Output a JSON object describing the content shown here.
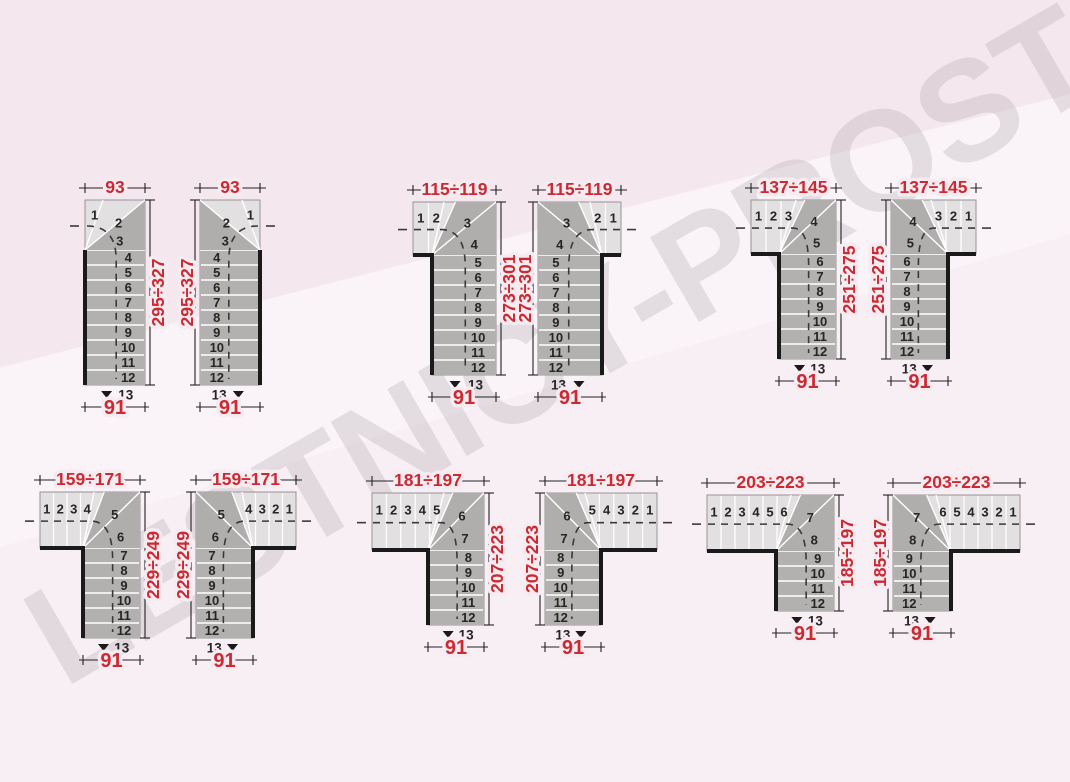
{
  "page": {
    "description": "Staircase layout dimension diagrams, 6 variants in left-hand and right-hand versions"
  },
  "watermark": {
    "text": "LESTNICY-PROSTO.RU"
  },
  "colors": {
    "background": "#f6ebf1",
    "step_light": "#e2e0e0",
    "step_dark": "#b3b0b0",
    "winder_dark": "#b0adad",
    "separator": "#ffffff",
    "outline": "#979595",
    "wall": "#1a1a1a",
    "walkline": "#3a3a3a",
    "dimension_red": "#cb2a32",
    "number_color": "#262626"
  },
  "stairs": [
    {
      "id": "93-left",
      "mirrored": false,
      "dimensions": {
        "top": "93",
        "side": "295÷327",
        "bottom": "91"
      },
      "step_numbers": {
        "arm": [],
        "winders": [
          "1",
          "2",
          "3"
        ],
        "flight": [
          "4",
          "5",
          "6",
          "7",
          "8",
          "9",
          "10",
          "11",
          "12"
        ],
        "last": "13"
      },
      "layout": {
        "left": 85,
        "top": 200,
        "total_w": 60,
        "flight_w": 60,
        "arm_w": 0,
        "arm_span": 0,
        "corner_h": 50,
        "step_depth": 15
      }
    },
    {
      "id": "93-right",
      "mirrored": true,
      "dimensions": {
        "top": "93",
        "side": "295÷327",
        "bottom": "91"
      },
      "step_numbers": {
        "arm": [],
        "winders": [
          "1",
          "2",
          "3"
        ],
        "flight": [
          "4",
          "5",
          "6",
          "7",
          "8",
          "9",
          "10",
          "11",
          "12"
        ],
        "last": "13"
      },
      "layout": {
        "left": 200,
        "top": 200,
        "total_w": 60,
        "flight_w": 60,
        "arm_w": 0,
        "arm_span": 0,
        "corner_h": 50,
        "step_depth": 15
      }
    },
    {
      "id": "115-119-left",
      "mirrored": false,
      "dimensions": {
        "top": "115÷119",
        "side": "273÷301",
        "bottom": "91"
      },
      "step_numbers": {
        "arm": [
          "1",
          "2"
        ],
        "winders": [
          "3",
          "4"
        ],
        "flight": [
          "5",
          "6",
          "7",
          "8",
          "9",
          "10",
          "11",
          "12"
        ],
        "last": "13"
      },
      "layout": {
        "left": 413,
        "top": 202,
        "total_w": 83,
        "flight_w": 64,
        "arm_w": 19,
        "arm_span": 31,
        "corner_h": 53,
        "step_depth": 15
      }
    },
    {
      "id": "115-119-right",
      "mirrored": true,
      "dimensions": {
        "top": "115÷119",
        "side": "273÷301",
        "bottom": "91"
      },
      "step_numbers": {
        "arm": [
          "1",
          "2"
        ],
        "winders": [
          "3",
          "4"
        ],
        "flight": [
          "5",
          "6",
          "7",
          "8",
          "9",
          "10",
          "11",
          "12"
        ],
        "last": "13"
      },
      "layout": {
        "left": 538,
        "top": 202,
        "total_w": 83,
        "flight_w": 64,
        "arm_w": 19,
        "arm_span": 31,
        "corner_h": 53,
        "step_depth": 15
      }
    },
    {
      "id": "137-145-left",
      "mirrored": false,
      "dimensions": {
        "top": "137÷145",
        "side": "251÷275",
        "bottom": "91"
      },
      "step_numbers": {
        "arm": [
          "1",
          "2",
          "3"
        ],
        "winders": [
          "4",
          "5"
        ],
        "flight": [
          "6",
          "7",
          "8",
          "9",
          "10",
          "11",
          "12"
        ],
        "last": "13"
      },
      "layout": {
        "left": 751,
        "top": 200,
        "total_w": 85,
        "flight_w": 57,
        "arm_w": 28,
        "arm_span": 45,
        "corner_h": 54,
        "step_depth": 15
      }
    },
    {
      "id": "137-145-right",
      "mirrored": true,
      "dimensions": {
        "top": "137÷145",
        "side": "251÷275",
        "bottom": "91"
      },
      "step_numbers": {
        "arm": [
          "1",
          "2",
          "3"
        ],
        "winders": [
          "4",
          "5"
        ],
        "flight": [
          "6",
          "7",
          "8",
          "9",
          "10",
          "11",
          "12"
        ],
        "last": "13"
      },
      "layout": {
        "left": 891,
        "top": 200,
        "total_w": 85,
        "flight_w": 57,
        "arm_w": 28,
        "arm_span": 45,
        "corner_h": 54,
        "step_depth": 15
      }
    },
    {
      "id": "159-171-left",
      "mirrored": false,
      "dimensions": {
        "top": "159÷171",
        "side": "229÷249",
        "bottom": "91"
      },
      "step_numbers": {
        "arm": [
          "1",
          "2",
          "3",
          "4"
        ],
        "winders": [
          "5",
          "6"
        ],
        "flight": [
          "7",
          "8",
          "9",
          "10",
          "11",
          "12"
        ],
        "last": "13"
      },
      "layout": {
        "left": 40,
        "top": 492,
        "total_w": 100,
        "flight_w": 57,
        "arm_w": 43,
        "arm_span": 54,
        "corner_h": 56,
        "step_depth": 15
      }
    },
    {
      "id": "159-171-right",
      "mirrored": true,
      "dimensions": {
        "top": "159÷171",
        "side": "229÷249",
        "bottom": "91"
      },
      "step_numbers": {
        "arm": [
          "1",
          "2",
          "3",
          "4"
        ],
        "winders": [
          "5",
          "6"
        ],
        "flight": [
          "7",
          "8",
          "9",
          "10",
          "11",
          "12"
        ],
        "last": "13"
      },
      "layout": {
        "left": 196,
        "top": 492,
        "total_w": 100,
        "flight_w": 57,
        "arm_w": 43,
        "arm_span": 54,
        "corner_h": 56,
        "step_depth": 15
      }
    },
    {
      "id": "181-197-left",
      "mirrored": false,
      "dimensions": {
        "top": "181÷197",
        "side": "207÷223",
        "bottom": "91"
      },
      "step_numbers": {
        "arm": [
          "1",
          "2",
          "3",
          "4",
          "5"
        ],
        "winders": [
          "6",
          "7"
        ],
        "flight": [
          "8",
          "9",
          "10",
          "11",
          "12"
        ],
        "last": "13"
      },
      "layout": {
        "left": 372,
        "top": 493,
        "total_w": 112,
        "flight_w": 56,
        "arm_w": 56,
        "arm_span": 72,
        "corner_h": 57,
        "step_depth": 15
      }
    },
    {
      "id": "181-197-right",
      "mirrored": true,
      "dimensions": {
        "top": "181÷197",
        "side": "207÷223",
        "bottom": "91"
      },
      "step_numbers": {
        "arm": [
          "1",
          "2",
          "3",
          "4",
          "5"
        ],
        "winders": [
          "6",
          "7"
        ],
        "flight": [
          "8",
          "9",
          "10",
          "11",
          "12"
        ],
        "last": "13"
      },
      "layout": {
        "left": 545,
        "top": 493,
        "total_w": 112,
        "flight_w": 56,
        "arm_w": 56,
        "arm_span": 72,
        "corner_h": 57,
        "step_depth": 15
      }
    },
    {
      "id": "203-223-left",
      "mirrored": false,
      "dimensions": {
        "top": "203÷223",
        "side": "185÷197",
        "bottom": "91"
      },
      "step_numbers": {
        "arm": [
          "1",
          "2",
          "3",
          "4",
          "5",
          "6"
        ],
        "winders": [
          "7",
          "8"
        ],
        "flight": [
          "9",
          "10",
          "11",
          "12"
        ],
        "last": "13"
      },
      "layout": {
        "left": 707,
        "top": 495,
        "total_w": 127,
        "flight_w": 58,
        "arm_w": 69,
        "arm_span": 84,
        "corner_h": 56,
        "step_depth": 15
      }
    },
    {
      "id": "203-223-right",
      "mirrored": true,
      "dimensions": {
        "top": "203÷223",
        "side": "185÷197",
        "bottom": "91"
      },
      "step_numbers": {
        "arm": [
          "1",
          "2",
          "3",
          "4",
          "5",
          "6"
        ],
        "winders": [
          "7",
          "8"
        ],
        "flight": [
          "9",
          "10",
          "11",
          "12"
        ],
        "last": "13"
      },
      "layout": {
        "left": 893,
        "top": 495,
        "total_w": 127,
        "flight_w": 58,
        "arm_w": 69,
        "arm_span": 84,
        "corner_h": 56,
        "step_depth": 15
      }
    }
  ]
}
